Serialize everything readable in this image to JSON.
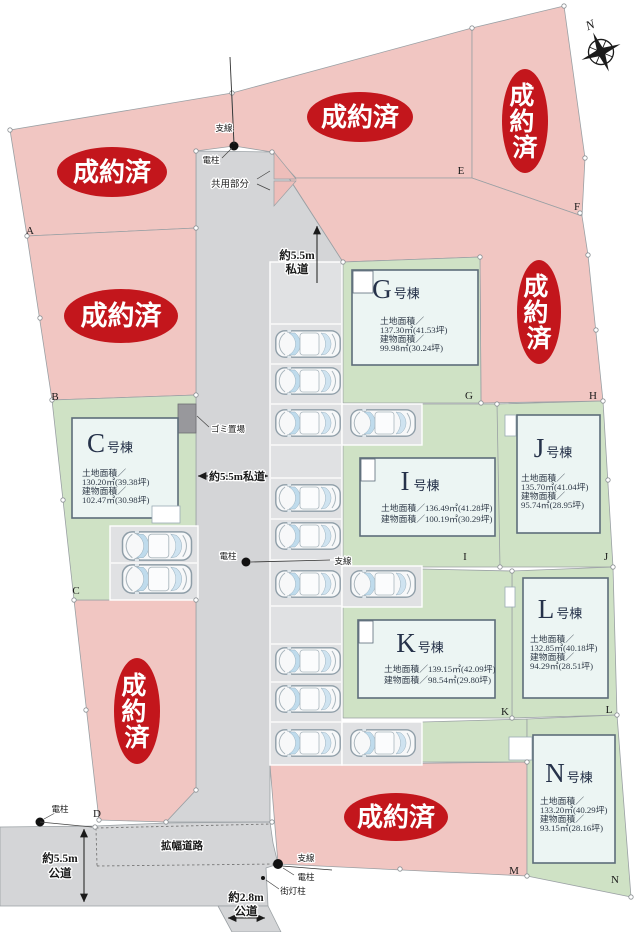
{
  "sold_stamp": {
    "text": "成約済",
    "chars": [
      "成",
      "約",
      "済"
    ]
  },
  "compass": {
    "north": "N"
  },
  "corners": [
    "A",
    "B",
    "C",
    "D",
    "E",
    "F",
    "G",
    "H",
    "I",
    "J",
    "K",
    "L",
    "M",
    "N"
  ],
  "buildings": {
    "C": {
      "letter": "C",
      "suffix": "号棟",
      "lines": [
        "土地面積／",
        "130.20㎡(39.38坪)",
        "建物面積／",
        "102.47㎡(30.98坪)"
      ]
    },
    "G": {
      "letter": "G",
      "suffix": "号棟",
      "lines": [
        "土地面積／",
        "137.30㎡(41.53坪)",
        "建物面積／",
        "99.98㎡(30.24坪)"
      ]
    },
    "I": {
      "letter": "I",
      "suffix": "号棟",
      "lines": [
        "土地面積／136.49㎡(41.28坪)",
        "建物面積／100.19㎡(30.29坪)"
      ]
    },
    "J": {
      "letter": "J",
      "suffix": "号棟",
      "lines": [
        "土地面積／",
        "135.70㎡(41.04坪)",
        "建物面積／",
        "95.74㎡(28.95坪)"
      ]
    },
    "K": {
      "letter": "K",
      "suffix": "号棟",
      "lines": [
        "土地面積／139.15㎡(42.09坪)",
        "建物面積／98.54㎡(29.80坪)"
      ]
    },
    "L": {
      "letter": "L",
      "suffix": "号棟",
      "lines": [
        "土地面積／",
        "132.85㎡(40.18坪)",
        "建物面積／",
        "94.29㎡(28.51坪)"
      ]
    },
    "N": {
      "letter": "N",
      "suffix": "号棟",
      "lines": [
        "土地面積／",
        "133.20㎡(40.29坪)",
        "建物面積／",
        "93.15㎡(28.16坪)"
      ]
    }
  },
  "roads": {
    "private_top": [
      "約5.5m",
      "私道"
    ],
    "private_mid": "約5.5m私道",
    "public_55": [
      "約5.5m",
      "公道"
    ],
    "public_28": [
      "約2.8m",
      "公道"
    ],
    "widened": "拡幅道路"
  },
  "site_labels": {
    "guy_wire": "支線",
    "utility_pole": "電柱",
    "common_area": "共用部分",
    "garbage_station": "ゴミ置場",
    "street_light": "街灯柱"
  },
  "colors": {
    "sold_lot": "#f1c6c2",
    "stamp_red": "#c3161c",
    "available_lot": "#cfe2c5",
    "road_gray": "#d4d5d7",
    "parking_pad": "#e0e1e3",
    "building_fill": "#ecf5f3",
    "building_border": "#5d6d7a"
  }
}
